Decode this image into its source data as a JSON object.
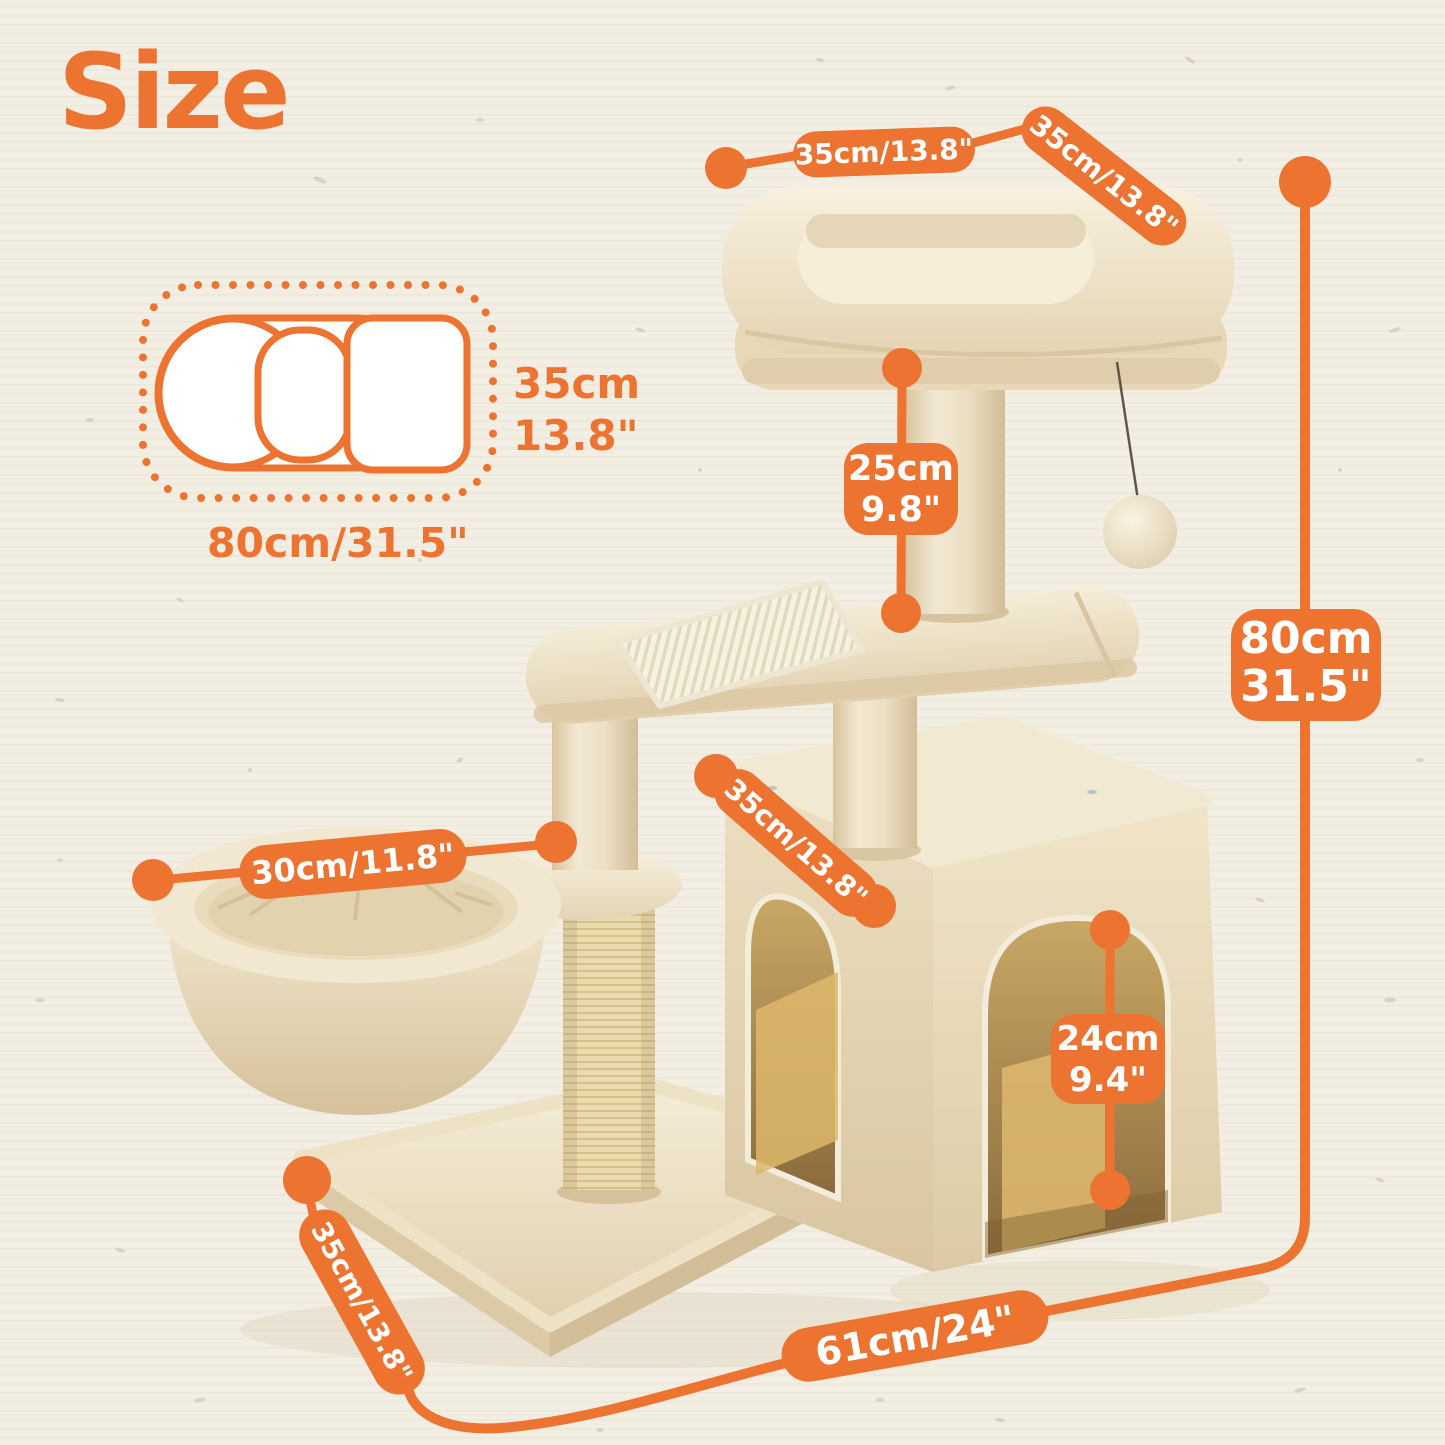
{
  "title": "Size",
  "colors": {
    "accent": "#ED7331",
    "background": "#F3EEE3",
    "plush": "#EFE4CB"
  },
  "footprint_diagram": {
    "depth_line1": "35cm",
    "depth_line2": "13.8\"",
    "width_label": "80cm/31.5\""
  },
  "labels": {
    "perch_width": "35cm/13.8\"",
    "perch_depth": "35cm/13.8\"",
    "upper_post_height": {
      "cm": "25cm",
      "inch": "9.8\""
    },
    "total_height": {
      "cm": "80cm",
      "inch": "31.5\""
    },
    "condo_width": "35cm/13.8\"",
    "basket_diameter": "30cm/11.8\"",
    "door_height": {
      "cm": "24cm",
      "inch": "9.4\""
    },
    "base_depth": "35cm/13.8\"",
    "base_width": "61cm/24\""
  }
}
